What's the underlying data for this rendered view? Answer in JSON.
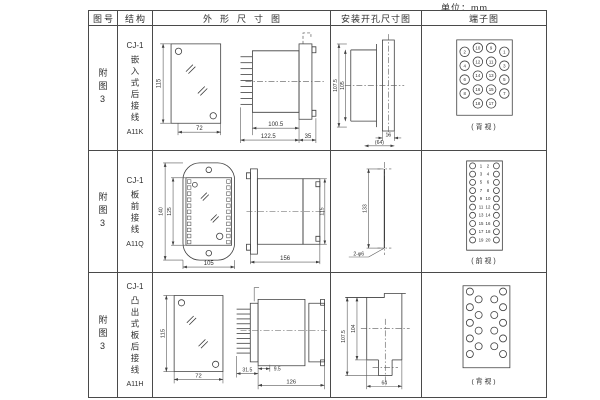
{
  "page": {
    "unit": "单位：mm"
  },
  "table": {
    "headers": [
      "图号",
      "结构",
      "外形尺寸图",
      "安装开孔尺寸图",
      "端子图"
    ],
    "rows": [
      {
        "fig": "附图3",
        "model": "CJ-1",
        "desc": "嵌入式后接线",
        "code": "A11K",
        "outline": {
          "height": "115",
          "width": "72",
          "body_len": "100.5",
          "total_len": "122.5",
          "flange": "35"
        },
        "install": {
          "outer_h": "107.5",
          "inner_h": "105",
          "slot_w": "16",
          "total_w": "(64)"
        },
        "terminal": {
          "view": "(背视)",
          "columns": [
            [
              "2",
              "4",
              "6",
              "8"
            ],
            [
              "10",
              "12",
              "14",
              "16",
              "18"
            ],
            [
              "9",
              "11",
              "13",
              "15",
              "17"
            ],
            [
              "1",
              "3",
              "5",
              "7"
            ]
          ]
        }
      },
      {
        "fig": "附图3",
        "model": "CJ-1",
        "desc": "板前接线",
        "code": "A11Q",
        "outline": {
          "outer_h": "140",
          "inner_h": "125",
          "width": "105",
          "depth": "156",
          "side_h": "115"
        },
        "install": {
          "hole_dist": "133",
          "hole_label": "2-φ6"
        },
        "terminal": {
          "view": "(前视)",
          "left": [
            "1",
            "3",
            "5",
            "7",
            "9",
            "11",
            "13",
            "15",
            "17",
            "19"
          ],
          "right": [
            "2",
            "4",
            "6",
            "8",
            "10",
            "12",
            "14",
            "16",
            "18",
            "20"
          ]
        }
      },
      {
        "fig": "附图3",
        "model": "CJ-1",
        "desc": "凸出式板后接线",
        "code": "A11H",
        "outline": {
          "height": "115",
          "width": "72",
          "pin_len": "31.5",
          "gap": "9.5",
          "body_len": "126"
        },
        "install": {
          "outer_h": "107.5",
          "inner_h": "104",
          "width": "64"
        },
        "terminal": {
          "view": "(背视)"
        }
      }
    ]
  }
}
